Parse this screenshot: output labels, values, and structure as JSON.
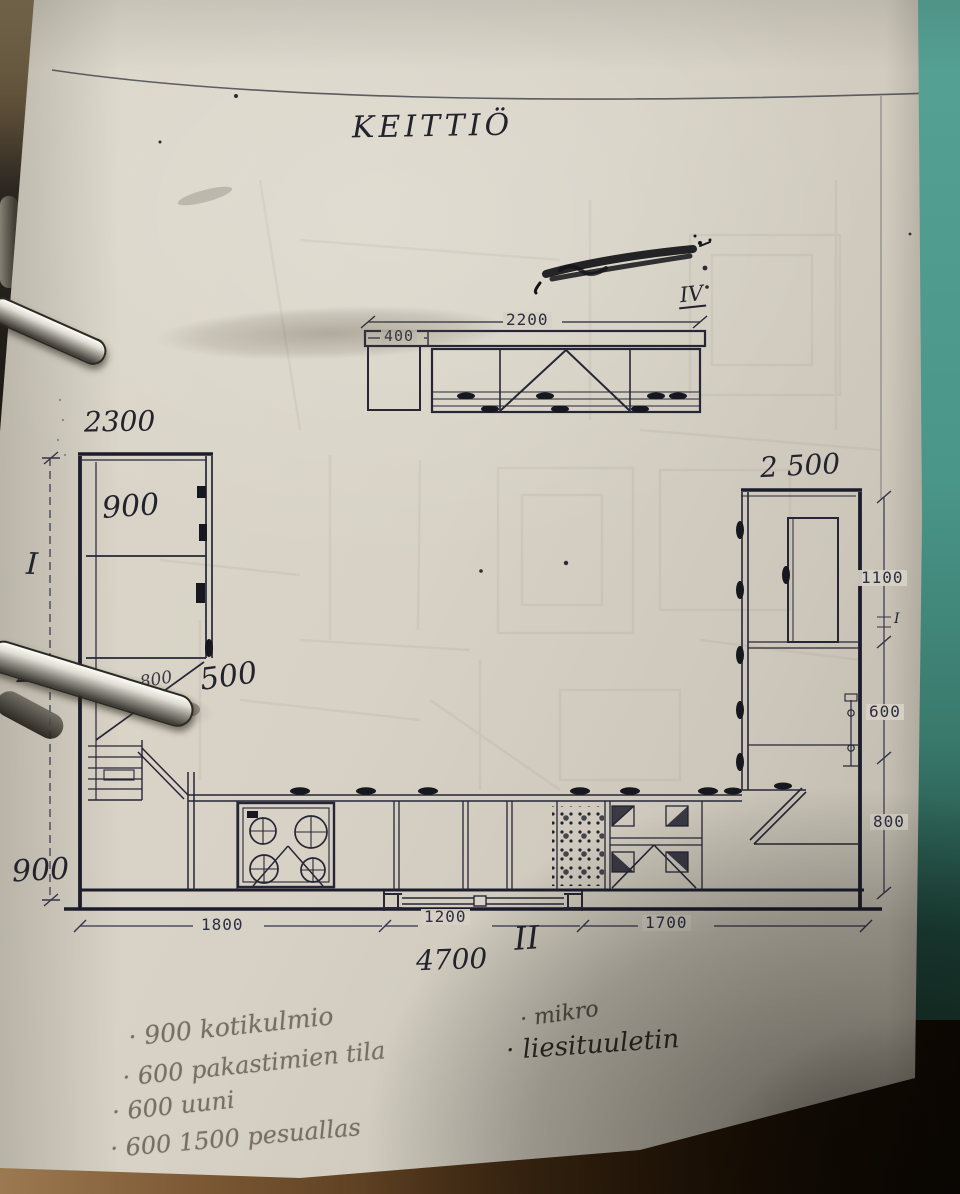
{
  "photo": {
    "title": "KEITTIÖ",
    "elevation": {
      "marker": "IV",
      "dim_total_width": "2200",
      "dim_left_section": "400"
    },
    "plan": {
      "marker_left": "I",
      "marker_bottom": "II",
      "marker_right": "I",
      "dim_left_wall": "2300",
      "dim_right_wall": "2 500",
      "dim_left_height": "2750",
      "dim_left_bottom": "900",
      "dim_total_bottom": "4700",
      "cabinet_left_tall": "900",
      "cabinet_corner": "800",
      "cabinet_depth": "500",
      "dim_right_upper": "1100",
      "dim_right_middle": "600",
      "dim_right_lower": "800",
      "dim_bottom_left": "1800",
      "dim_bottom_window": "1200",
      "dim_bottom_right": "1700"
    },
    "notes_left": [
      "·  900 kotikulmio",
      "·  600 pakastimien tila",
      "·  600 uuni",
      "·  600 1500 pesuallas"
    ],
    "notes_right": [
      "· mikro",
      "· liesituuletin"
    ]
  }
}
